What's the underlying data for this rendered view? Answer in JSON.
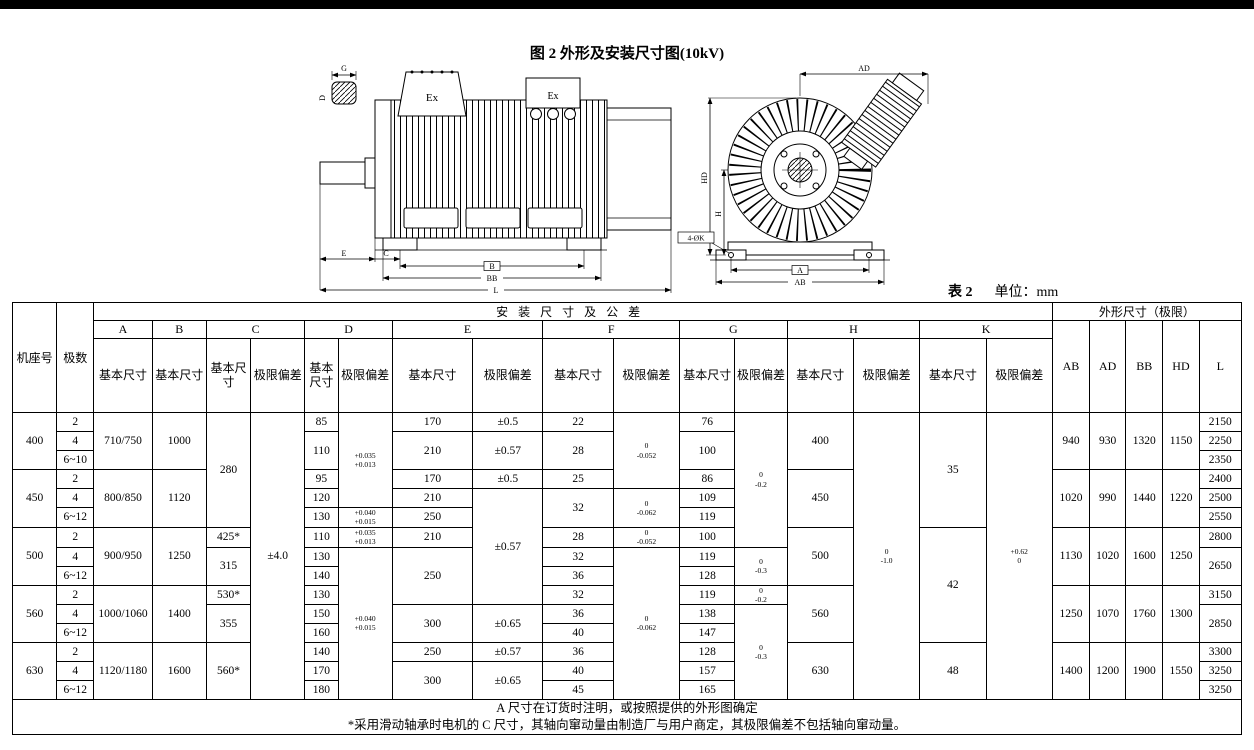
{
  "page": {
    "title": "图 2  外形及安装尺寸图(10kV)",
    "table_label": "表 2",
    "unit_label": "单位：mm"
  },
  "drawing": {
    "ex_label_1": "Ex",
    "ex_label_2": "Ex",
    "dims": {
      "g": "G",
      "d": "D",
      "e": "E",
      "c": "C",
      "b": "B",
      "bb": "BB",
      "l": "L",
      "ad": "AD",
      "hd": "HD",
      "h": "H",
      "a": "A",
      "ab": "AB",
      "k4": "4-ØK"
    }
  },
  "table": {
    "headers": {
      "frame": "机座号",
      "poles": "极数",
      "install": "安装尺寸及公差",
      "outline": "外形尺寸（极限）",
      "basic": "基本尺寸",
      "dev": "极限偏差",
      "groups": [
        "A",
        "B",
        "C",
        "D",
        "E",
        "F",
        "G",
        "H",
        "K"
      ],
      "outline_cols": [
        "AB",
        "AD",
        "BB",
        "HD",
        "L"
      ]
    },
    "body": [
      [
        {
          "t": "400",
          "rs": 3
        },
        {
          "t": "2"
        },
        {
          "t": "710/750",
          "rs": 3
        },
        {
          "t": "1000",
          "rs": 3
        },
        {
          "t": "280",
          "rs": 6
        },
        {
          "t": "±4.0",
          "rs": 15
        },
        {
          "t": "85"
        },
        {
          "t": "+0.035|+0.013",
          "rs": 5,
          "sm": 1
        },
        {
          "t": "170"
        },
        {
          "t": "±0.5"
        },
        {
          "t": "22"
        },
        {
          "t": "0|-0.052",
          "rs": 4,
          "sm": 1
        },
        {
          "t": "76"
        },
        {
          "t": "0|-0.2",
          "rs": 7,
          "sm": 1
        },
        {
          "t": "400",
          "rs": 3
        },
        {
          "t": "0|-1.0",
          "rs": 15,
          "sm": 1
        },
        {
          "t": "35",
          "rs": 6
        },
        {
          "t": "+0.62|0",
          "rs": 15,
          "sm": 1
        },
        {
          "t": "940",
          "rs": 3
        },
        {
          "t": "930",
          "rs": 3
        },
        {
          "t": "1320",
          "rs": 3
        },
        {
          "t": "1150",
          "rs": 3
        },
        {
          "t": "2150"
        }
      ],
      [
        {
          "t": "4"
        },
        {
          "t": "110",
          "rs": 2
        },
        {
          "t": "210",
          "rs": 2
        },
        {
          "t": "±0.57",
          "rs": 2
        },
        {
          "t": "28",
          "rs": 2
        },
        {
          "t": "100",
          "rs": 2
        },
        {
          "t": "2250"
        }
      ],
      [
        {
          "t": "6~10"
        },
        {
          "t": "2350"
        }
      ],
      [
        {
          "t": "450",
          "rs": 3
        },
        {
          "t": "2"
        },
        {
          "t": "800/850",
          "rs": 3
        },
        {
          "t": "1120",
          "rs": 3
        },
        {
          "t": "95"
        },
        {
          "t": "170"
        },
        {
          "t": "±0.5"
        },
        {
          "t": "25"
        },
        {
          "t": "86"
        },
        {
          "t": "450",
          "rs": 3
        },
        {
          "t": "1020",
          "rs": 3
        },
        {
          "t": "990",
          "rs": 3
        },
        {
          "t": "1440",
          "rs": 3
        },
        {
          "t": "1220",
          "rs": 3
        },
        {
          "t": "2400"
        }
      ],
      [
        {
          "t": "4"
        },
        {
          "t": "120"
        },
        {
          "t": "210"
        },
        {
          "t": "±0.57",
          "rs": 6
        },
        {
          "t": "32",
          "rs": 2
        },
        {
          "t": "0|-0.062",
          "rs": 2,
          "sm": 1
        },
        {
          "t": "109"
        },
        {
          "t": "2500"
        }
      ],
      [
        {
          "t": "6~12"
        },
        {
          "t": "130"
        },
        {
          "t": "+0.040|+0.015",
          "sm": 1
        },
        {
          "t": "250"
        },
        {
          "t": "119"
        },
        {
          "t": "2550"
        }
      ],
      [
        {
          "t": "500",
          "rs": 3
        },
        {
          "t": "2"
        },
        {
          "t": "900/950",
          "rs": 3
        },
        {
          "t": "1250",
          "rs": 3
        },
        {
          "t": "425*"
        },
        {
          "t": "110"
        },
        {
          "t": "+0.035|+0.013",
          "sm": 1
        },
        {
          "t": "210"
        },
        {
          "t": "28"
        },
        {
          "t": "0|-0.052",
          "sm": 1
        },
        {
          "t": "100"
        },
        {
          "t": "500",
          "rs": 3
        },
        {
          "t": "42",
          "rs": 6
        },
        {
          "t": "1130",
          "rs": 3
        },
        {
          "t": "1020",
          "rs": 3
        },
        {
          "t": "1600",
          "rs": 3
        },
        {
          "t": "1250",
          "rs": 3
        },
        {
          "t": "2800"
        }
      ],
      [
        {
          "t": "4"
        },
        {
          "t": "315",
          "rs": 2
        },
        {
          "t": "130"
        },
        {
          "t": "+0.040|+0.015",
          "rs": 8,
          "sm": 1
        },
        {
          "t": "250",
          "rs": 3
        },
        {
          "t": "32"
        },
        {
          "t": "0|-0.062",
          "rs": 8,
          "sm": 1
        },
        {
          "t": "119"
        },
        {
          "t": "0|-0.3",
          "rs": 2,
          "sm": 1
        },
        {
          "t": "2650",
          "rs": 2
        }
      ],
      [
        {
          "t": "6~12"
        },
        {
          "t": "140"
        },
        {
          "t": "36"
        },
        {
          "t": "128"
        }
      ],
      [
        {
          "t": "560",
          "rs": 3
        },
        {
          "t": "2"
        },
        {
          "t": "1000/1060",
          "rs": 3
        },
        {
          "t": "1400",
          "rs": 3
        },
        {
          "t": "530*"
        },
        {
          "t": "130"
        },
        {
          "t": "32"
        },
        {
          "t": "119"
        },
        {
          "t": "0|-0.2",
          "sm": 1
        },
        {
          "t": "560",
          "rs": 3
        },
        {
          "t": "1250",
          "rs": 3
        },
        {
          "t": "1070",
          "rs": 3
        },
        {
          "t": "1760",
          "rs": 3
        },
        {
          "t": "1300",
          "rs": 3
        },
        {
          "t": "3150"
        }
      ],
      [
        {
          "t": "4"
        },
        {
          "t": "355",
          "rs": 2
        },
        {
          "t": "150"
        },
        {
          "t": "300",
          "rs": 2
        },
        {
          "t": "±0.65",
          "rs": 2
        },
        {
          "t": "36"
        },
        {
          "t": "138"
        },
        {
          "t": "0|-0.3",
          "rs": 5,
          "sm": 1
        },
        {
          "t": "2850",
          "rs": 2
        }
      ],
      [
        {
          "t": "6~12"
        },
        {
          "t": "160"
        },
        {
          "t": "40"
        },
        {
          "t": "147"
        }
      ],
      [
        {
          "t": "630",
          "rs": 3
        },
        {
          "t": "2"
        },
        {
          "t": "1120/1180",
          "rs": 3
        },
        {
          "t": "1600",
          "rs": 3
        },
        {
          "t": "560*",
          "rs": 3
        },
        {
          "t": "140"
        },
        {
          "t": "250"
        },
        {
          "t": "±0.57"
        },
        {
          "t": "36"
        },
        {
          "t": "128"
        },
        {
          "t": "630",
          "rs": 3
        },
        {
          "t": "48",
          "rs": 3
        },
        {
          "t": "1400",
          "rs": 3
        },
        {
          "t": "1200",
          "rs": 3
        },
        {
          "t": "1900",
          "rs": 3
        },
        {
          "t": "1550",
          "rs": 3
        },
        {
          "t": "3300"
        }
      ],
      [
        {
          "t": "4"
        },
        {
          "t": "170"
        },
        {
          "t": "300",
          "rs": 2
        },
        {
          "t": "±0.65",
          "rs": 2
        },
        {
          "t": "40"
        },
        {
          "t": "157"
        },
        {
          "t": "3250"
        }
      ],
      [
        {
          "t": "6~12"
        },
        {
          "t": "180"
        },
        {
          "t": "45"
        },
        {
          "t": "165"
        },
        {
          "t": "3250"
        }
      ]
    ],
    "notes": [
      "A 尺寸在订货时注明，或按照提供的外形图确定",
      "*采用滑动轴承时电机的 C 尺寸，其轴向窜动量由制造厂与用户商定，其极限偏差不包括轴向窜动量。"
    ]
  }
}
